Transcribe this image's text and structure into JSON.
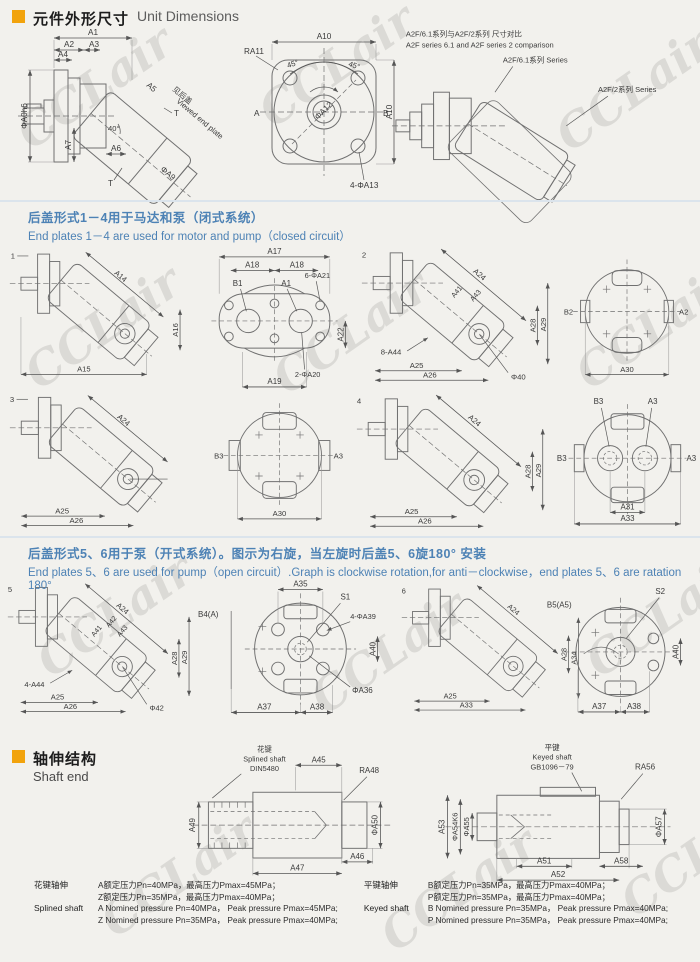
{
  "watermark": "CCLair",
  "colors": {
    "accent_orange": "#f2a30c",
    "accent_blue": "#4d82b5"
  },
  "header_unit": {
    "zh": "元件外形尺寸",
    "en": "Unit Dimensions"
  },
  "comparison": {
    "title_zh": "A2F/6.1系列与A2F/2系列 尺寸对比",
    "title_en": "A2F series 6.1 and A2F series 2 comparison",
    "label_61": "A2F/6.1系列 Series",
    "label_2": "A2F/2系列 Series"
  },
  "side_view": {
    "A1": "A1",
    "A2": "A2",
    "A3": "A3",
    "A4": "A4",
    "A5": "A5",
    "A6": "A6",
    "A7": "A7",
    "D0": "ΦA0h6",
    "ANG": "40°",
    "T1": "T",
    "T2": "T",
    "VIEW_ZH": "见后盖",
    "VIEW_EN": "Viewed end plate",
    "D9": "ΦA9"
  },
  "flange_view": {
    "A10T": "A10",
    "ANG_L": "45°",
    "ANG_R": "45°",
    "R11": "RA11",
    "D12": "ΦA12",
    "PA": "A",
    "PB": "B",
    "A10R": "A10",
    "HOLES": "4-ΦA13"
  },
  "sec14": {
    "zh": "后盖形式1－4用于马达和泵（闭式系统）",
    "en": "End plates 1－4 are used for motor and pump（closed circuit）"
  },
  "d1": {
    "num": "1",
    "A14": "A14",
    "A16": "A16",
    "A15": "A15"
  },
  "plate1": {
    "A17": "A17",
    "A18L": "A18",
    "A18R": "A18",
    "B1": "B1",
    "A1": "A1",
    "H21": "6-ΦA21",
    "A22": "A22",
    "H20": "2-ΦA20",
    "A19": "A19"
  },
  "d2": {
    "num": "2",
    "A24": "A24",
    "A41": "A41",
    "A43": "A43",
    "A28": "A28",
    "A29": "A29",
    "H44": "8-A44",
    "A25": "A25",
    "A26": "A26",
    "D40": "Φ40"
  },
  "c2": {
    "B": "B2",
    "A": "A2",
    "A30": "A30"
  },
  "d3": {
    "num": "3",
    "A24": "A24",
    "A25": "A25",
    "A26": "A26"
  },
  "c3": {
    "B": "B3",
    "A": "A3",
    "A30": "A30"
  },
  "d4": {
    "num": "4",
    "A24": "A24",
    "A28": "A28",
    "A29": "A29",
    "A25": "A25",
    "A26": "A26"
  },
  "c4": {
    "BT": "B3",
    "AT": "A3",
    "BL": "B3",
    "AR": "A3",
    "A31": "A31",
    "A33": "A33"
  },
  "sec56": {
    "zh": "后盖形式5、6用于泵（开式系统）。图示为右旋，当左旋时后盖5、6旋180°  安装",
    "en": "End plates 5、6 are used for pump（open circuit）.Graph is clockwise rotation,for anti－clockwise，end plates 5、6 are ratation 180°"
  },
  "d5": {
    "num": "5",
    "A24": "A24",
    "A41": "A41",
    "A42": "A42",
    "A43": "A43",
    "A28": "A28",
    "A29": "A29",
    "H44": "4-A44",
    "A25": "A25",
    "A26": "A26",
    "D42": "Φ42"
  },
  "c5": {
    "A35": "A35",
    "S1": "S1",
    "B4": "B4(A)",
    "H39": "4-ΦA39",
    "A40": "A40",
    "D36": "ΦA36",
    "A37": "A37",
    "A38": "A38"
  },
  "d6": {
    "num": "6",
    "A24": "A24",
    "A28": "A28",
    "A34": "A34",
    "A25": "A25",
    "A33": "A33"
  },
  "c6": {
    "B5": "B5(A5)",
    "S2": "S2",
    "A40": "A40",
    "A37": "A37",
    "A38": "A38"
  },
  "header_shaft": {
    "zh": "轴伸结构",
    "en": "Shaft end"
  },
  "spline": {
    "note_zh": "花键",
    "note_en": "Splined shaft",
    "std": "DIN5480",
    "A45": "A45",
    "R48": "RA48",
    "A49": "A49",
    "D50": "ΦA50",
    "A47": "A47",
    "A46": "A46"
  },
  "keyed": {
    "note_zh": "平键",
    "note_en": "Keyed shaft",
    "std": "GB1096－79",
    "R56": "RA56",
    "A53": "A53",
    "D54": "ΦA54K6",
    "D55": "ΦA55",
    "D57": "ΦA57",
    "A51": "A51",
    "A58": "A58",
    "A52": "A52"
  },
  "specs": {
    "spline_zh": "花键轴伸",
    "spline_en": "Splined shaft",
    "s1": "A额定压力Pn=40MPa，最高压力Pmax=45MPa；",
    "s2": "Z额定压力Pn=35MPa，最高压力Pmax=40MPa；",
    "s3": "A Nomined pressure Pn=40MPa， Peak pressure Pmax=45MPa;",
    "s4": "Z Nomined pressure Pn=35MPa， Peak pressure Pmax=40MPa;",
    "key_zh": "平键轴伸",
    "key_en": "Keyed shaft",
    "k1": "B额定压力Pn=35MPa，最高压力Pmax=40MPa；",
    "k2": "P额定压力Pn=35MPa，最高压力Pmax=40MPa；",
    "k3": "B Nomined pressure Pn=35MPa， Peak pressure Pmax=40MPa;",
    "k4": "P Nomined pressure Pn=35MPa， Peak pressure Pmax=40MPa;"
  }
}
